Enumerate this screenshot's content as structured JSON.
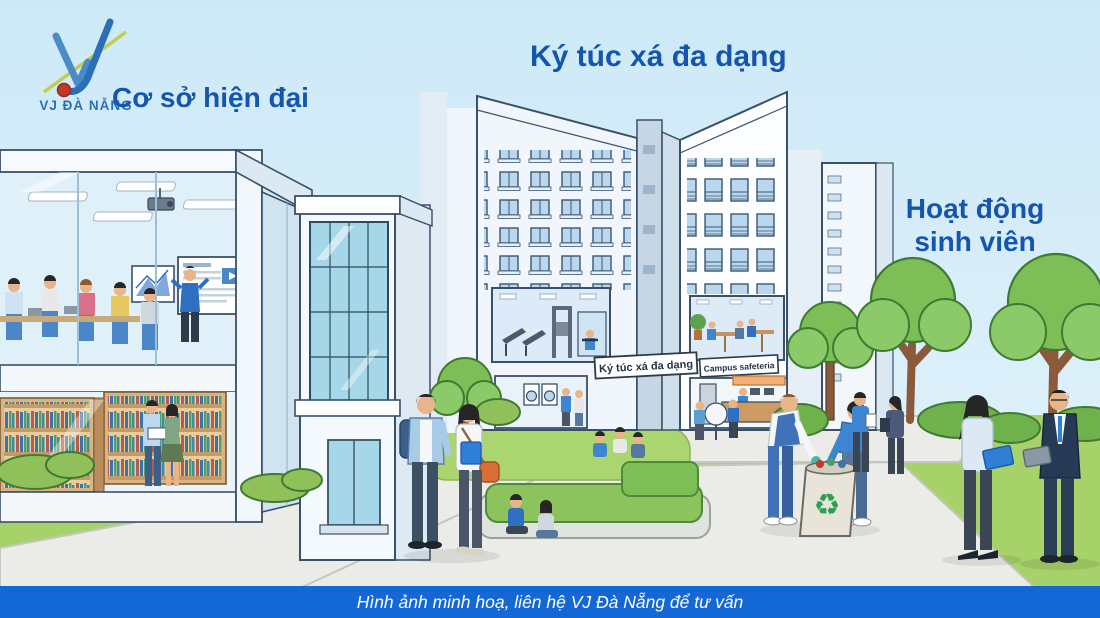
{
  "branding": {
    "logo_text": "VJ ĐÀ NẴNG"
  },
  "captions": {
    "facilities": "Cơ sở hiện đại",
    "dormitory": "Ký túc xá đa dạng",
    "activities_line1": "Hoạt động",
    "activities_line2": "sinh viên"
  },
  "signs": {
    "dormitory_sign": "Ký túc xá đa dạng",
    "cafeteria_sign": "Campus safeteria"
  },
  "footer": {
    "note": "Hình ảnh minh hoạ, liên hệ VJ Đà Nẵng để tư vấn"
  },
  "icons": {
    "recycle": "♻"
  },
  "colors": {
    "caption_blue": "#1456ad",
    "footer_bar_blue": "#1468d6",
    "sky_blue": "#d0eaf7",
    "grass_green": "#a7d169",
    "path_gray": "#ebece7",
    "accent_orange": "#e07a38",
    "recycle_green": "#2e9e4f"
  }
}
